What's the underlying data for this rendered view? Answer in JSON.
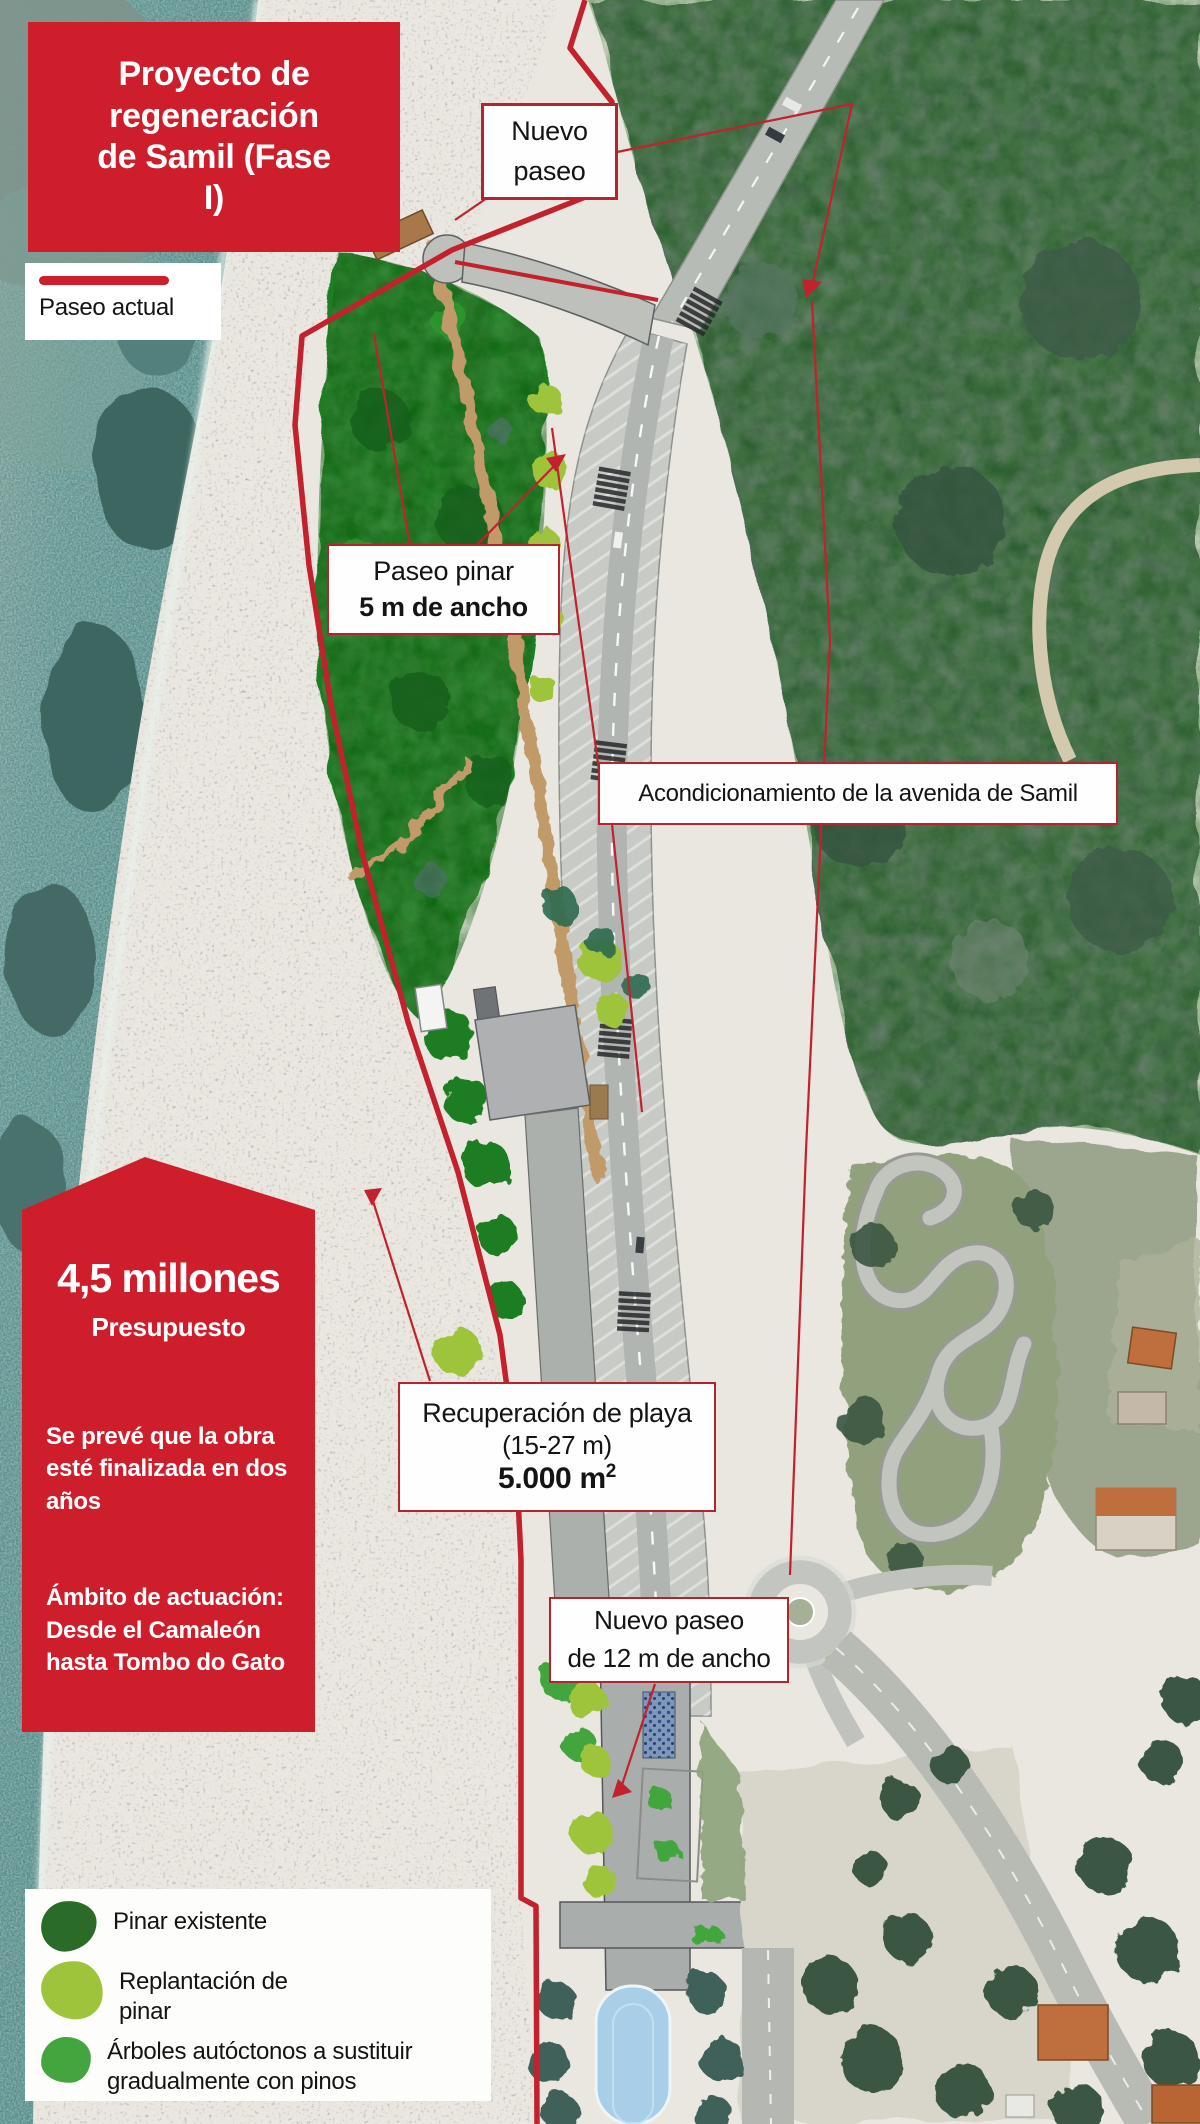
{
  "header": {
    "title": "Proyecto de regeneración de Samil (Fase I)"
  },
  "current_path_legend": {
    "label": "Paseo actual"
  },
  "callouts": {
    "nuevo_paseo_top": "Nuevo paseo",
    "paseo_pinar": {
      "line1": "Paseo pinar",
      "line2": "5 m de ancho"
    },
    "avenida": "Acondicionamiento de la avenida de Samil",
    "recuperacion": {
      "line1": "Recuperación de playa",
      "line2": "(15-27 m)",
      "area_value": "5.000 m",
      "area_sup": "2"
    },
    "nuevo_paseo_12": {
      "line1": "Nuevo paseo",
      "line2": "de 12 m de ancho"
    }
  },
  "budget_box": {
    "amount": "4,5 millones",
    "amount_label": "Presupuesto",
    "timeline": "Se prevé que la obra esté finalizada en dos años",
    "scope": "Ámbito de actuación: Desde el Camaleón hasta Tombo do Gato"
  },
  "tree_legend": {
    "items": [
      {
        "label": "Pinar existente",
        "color": "#2a6b27"
      },
      {
        "label": "Replantación de pinar",
        "color": "#9dc43b"
      },
      {
        "label": "Árboles autóctonos a sustituir gradualmente con pinos",
        "color": "#43a53e"
      }
    ]
  },
  "palette": {
    "accent_red": "#cf1e2b",
    "callout_border": "#b5242e",
    "ocean": "#578f8c",
    "sand": "#e9e7e0",
    "pine_green": "#1e7d21",
    "east_forest": "#4d6a54",
    "replant_lime": "#9dc43b",
    "native_green": "#43a53e",
    "road_gray": "#c7cac5",
    "pool_blue": "#a9cee7"
  }
}
